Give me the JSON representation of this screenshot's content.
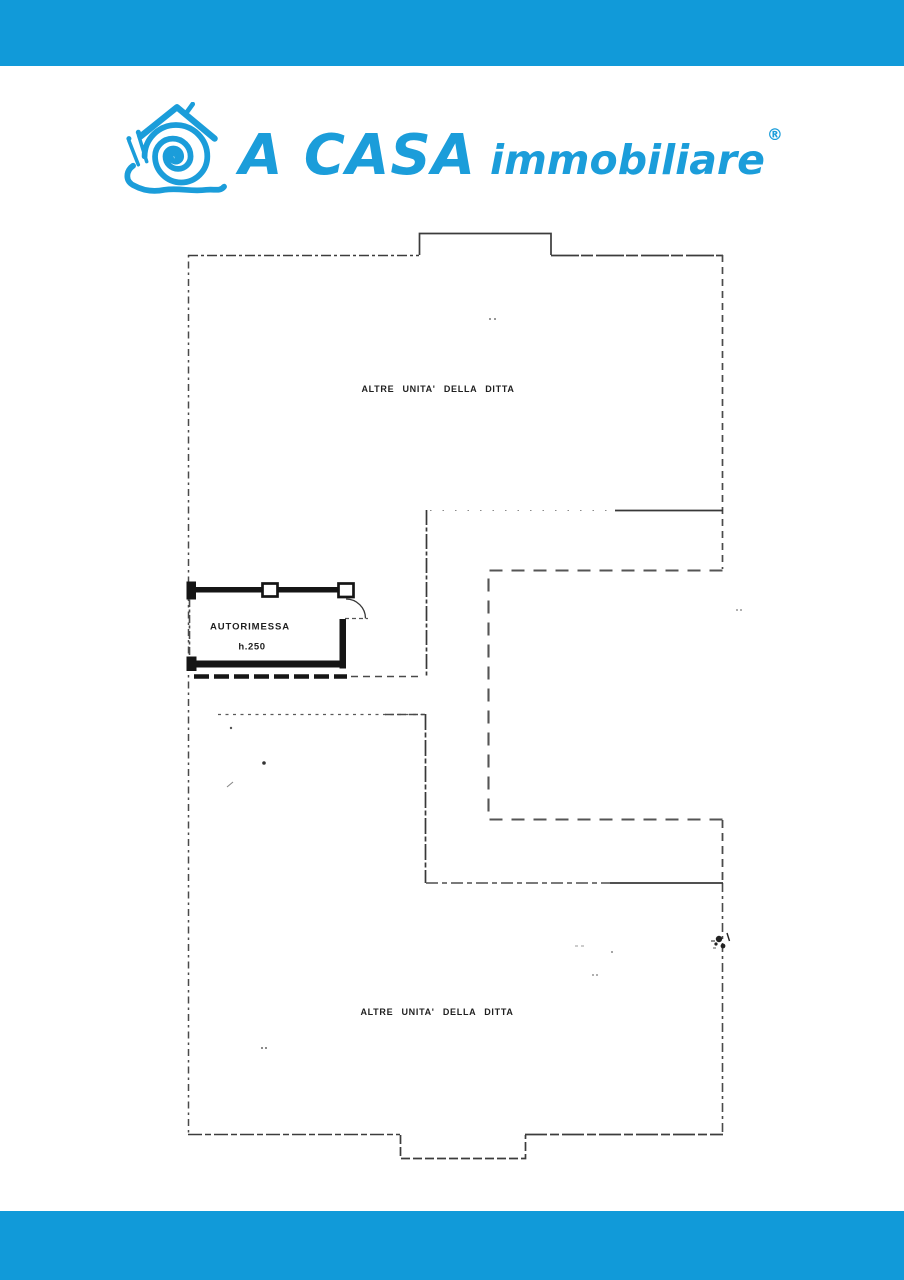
{
  "brand": {
    "name_primary": "A CASA",
    "name_secondary": "immobiliare",
    "registered_mark": "®",
    "logo_icon": "snail-house-icon",
    "accent_color": "#1b9dda",
    "bar_color": "#119ad9"
  },
  "floorplan": {
    "line_color": "#3a3a3a",
    "labels": {
      "top_area": "ALTRE UNITA' DELLA DITTA",
      "bottom_area": "ALTRE UNITA' DELLA DITTA",
      "garage": "AUTORIMESSA",
      "garage_height": "h.250"
    }
  }
}
